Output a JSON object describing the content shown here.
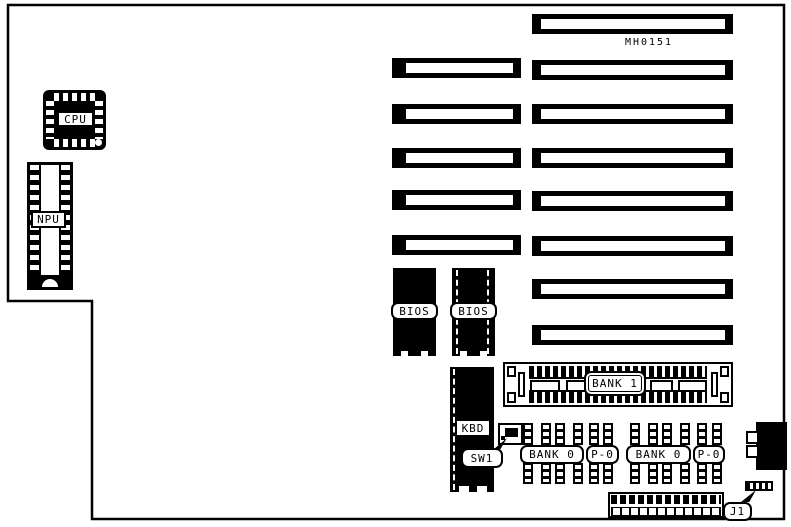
{
  "diagram": {
    "model_number": "MH0151",
    "components": {
      "cpu": "CPU",
      "npu": "NPU",
      "bios_1": "BIOS",
      "bios_2": "BIOS",
      "bank_1": "BANK 1",
      "keyboard_header": "KBD",
      "switch_1": "SW1",
      "bank_0_left": "BANK 0",
      "parity_left": "P-0",
      "bank_0_right": "BANK 0",
      "parity_right": "P-0",
      "jumper_1": "J1"
    },
    "slots": {
      "left_column_count": 5,
      "right_column_count": 8
    },
    "colors": {
      "ink": "#000000",
      "paper": "#ffffff"
    }
  }
}
